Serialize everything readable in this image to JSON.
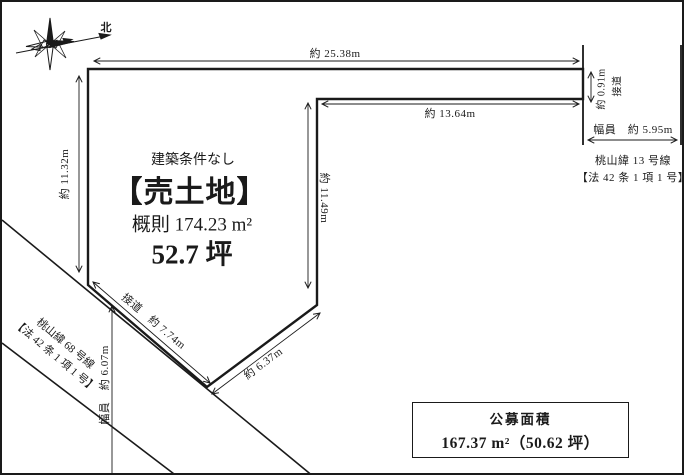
{
  "compass": {
    "north_label": "北"
  },
  "listing": {
    "condition": "建築条件なし",
    "title": "【売土地】",
    "area_approx": "概則 174.23 m²",
    "area_tsubo": "52.7 坪"
  },
  "dimensions": {
    "top_edge": "約 25.38m",
    "upper_inner_edge": "約 13.64m",
    "left_edge": "約 11.32m",
    "middle_vertical_edge": "約 11.49m",
    "right_small_edge": "約 0.91m",
    "right_frontage_label": "接道",
    "right_road_width": "幅員　約 5.95m",
    "bottom_frontage": "接道　約 7.74m",
    "bottom_diagonal_edge": "約 6.37m",
    "left_road_width": "幅員　約 6.07m"
  },
  "roads": {
    "right": {
      "name": "桃山緯 13 号線",
      "law": "【法 42 条 1 項 1 号】"
    },
    "left": {
      "name": "桃山緯 68 号線",
      "law": "【法 42 条 1 項 1 号】"
    }
  },
  "registered_area_box": {
    "title": "公募面積",
    "value": "167.37 m²（50.62 坪）"
  }
}
